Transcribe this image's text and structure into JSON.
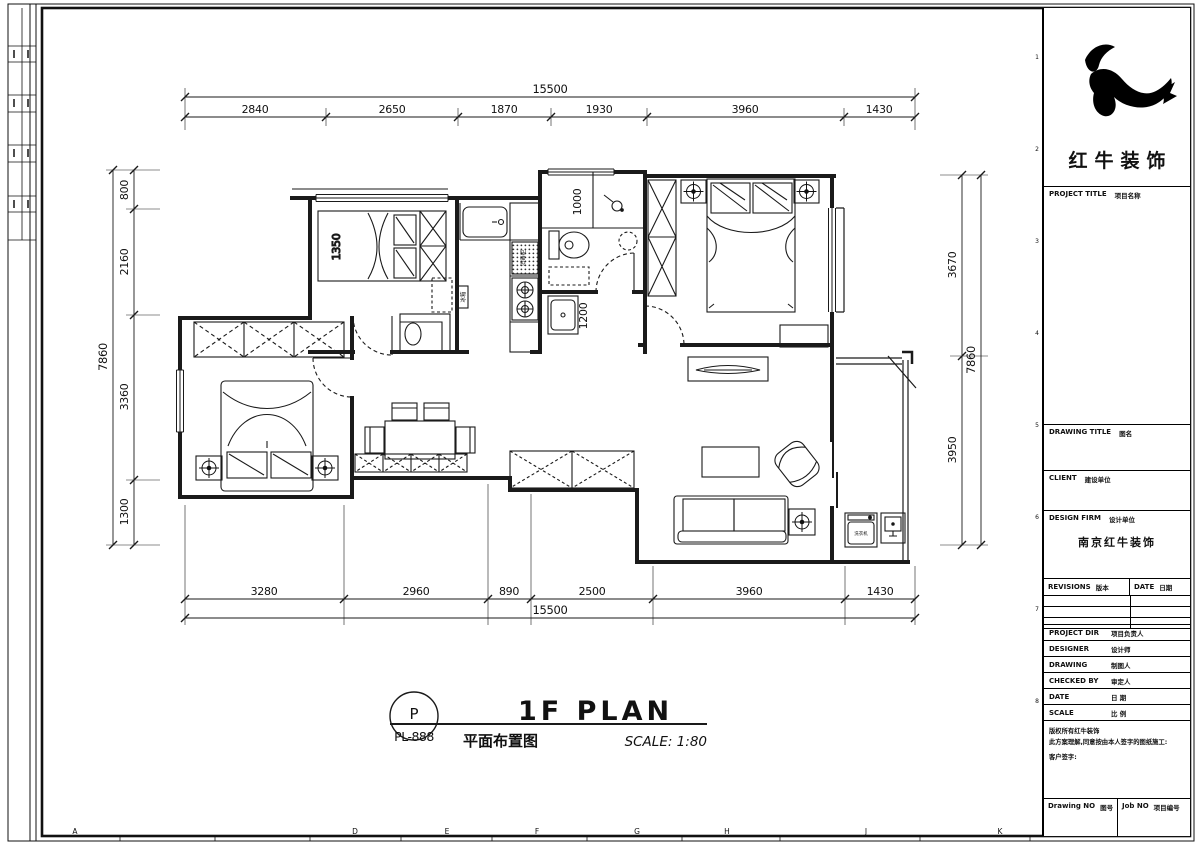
{
  "frame": {
    "grid_letters": [
      "A",
      "D",
      "E",
      "F",
      "G",
      "H",
      "J",
      "K"
    ],
    "grid_numbers": [
      "1",
      "2",
      "3",
      "4",
      "5",
      "6",
      "7",
      "8"
    ]
  },
  "brand": {
    "company": "红牛装饰"
  },
  "title_block": {
    "project_title_en": "PROJECT TITLE",
    "project_title_zh": "项目名称",
    "drawing_title_en": "DRAWING TITLE",
    "drawing_title_zh": "图名",
    "client_en": "CLIENT",
    "client_zh": "建设单位",
    "design_firm_en": "DESIGN FIRM",
    "design_firm_zh": "设计单位",
    "design_firm_value": "南京红牛装饰",
    "revisions_en": "REVISIONS",
    "revisions_zh": "版本",
    "date_col_en": "DATE",
    "date_col_zh": "日期",
    "rows": [
      {
        "en": "PROJECT DIR",
        "zh": "项目负责人"
      },
      {
        "en": "DESIGNER",
        "zh": "设计师"
      },
      {
        "en": "DRAWING",
        "zh": "制图人"
      },
      {
        "en": "CHECKED BY",
        "zh": "审定人"
      },
      {
        "en": "DATE",
        "zh": "日 期"
      },
      {
        "en": "SCALE",
        "zh": "比 例"
      }
    ],
    "copyright_line1": "版权所有红牛装饰",
    "copyright_line2": "此方案理解,同意按由本人签字的图纸施工:",
    "copyright_line3": "客户签字:",
    "drawing_no_en": "Drawing NO",
    "drawing_no_zh": "图号",
    "job_no_en": "Job NO",
    "job_no_zh": "项目编号"
  },
  "plan_title": {
    "ref_top": "P",
    "ref_bottom": "PL-888",
    "title": "1F PLAN",
    "subtitle": "平面布置图",
    "scale": "SCALE: 1:80"
  },
  "dims": {
    "top": {
      "total": "15500",
      "segments": [
        "2840",
        "2650",
        "1870",
        "1930",
        "3960",
        "1430"
      ]
    },
    "bottom": {
      "total": "15500",
      "segments": [
        "3280",
        "2960",
        "890",
        "2500",
        "3960",
        "1430"
      ]
    },
    "left": {
      "total": "7860",
      "segments": [
        "800",
        "2160",
        "3360",
        "1300"
      ]
    },
    "right": {
      "total": "7860",
      "segments": [
        "3670",
        "3950"
      ]
    }
  },
  "plan_labels": {
    "bed_width": "1350",
    "shower_width": "1000",
    "washer_width": "1200",
    "kitchen_cabinet": "消毒柜",
    "fridge": "冰箱",
    "balcony_washer": "洗衣机"
  }
}
